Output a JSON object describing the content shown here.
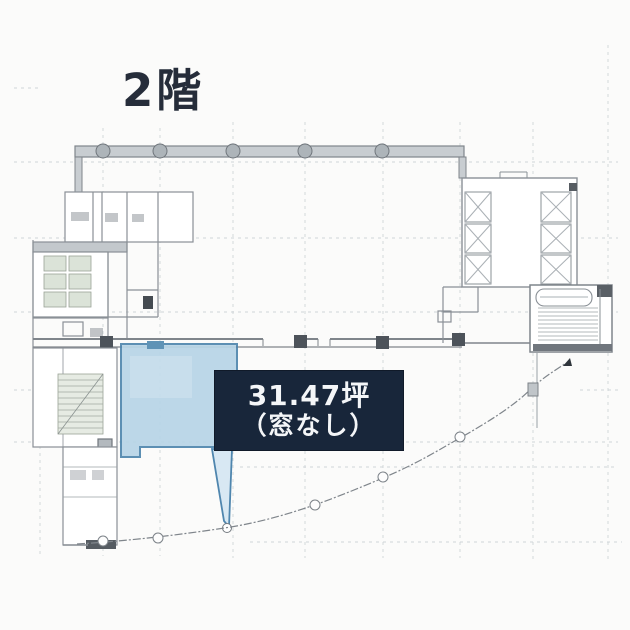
{
  "floor_title": {
    "label": "2階"
  },
  "area_label": {
    "line1": "31.47坪",
    "line2": "（窓なし）",
    "background": "#18263a",
    "text_color": "#f4f6f8"
  },
  "plan": {
    "paper_color": "#fbfbfa",
    "grid_color": "#cfd4d8",
    "wall_color": "#868c92",
    "wall_dark_color": "#4d535a",
    "column_marker_fill": "#adb4b9",
    "highlight_fill": "#b7d5e7",
    "highlight_border": "#4f86ae",
    "wedge_fill": "#d8e8f3",
    "stall_fill": "#dbe3d8"
  }
}
